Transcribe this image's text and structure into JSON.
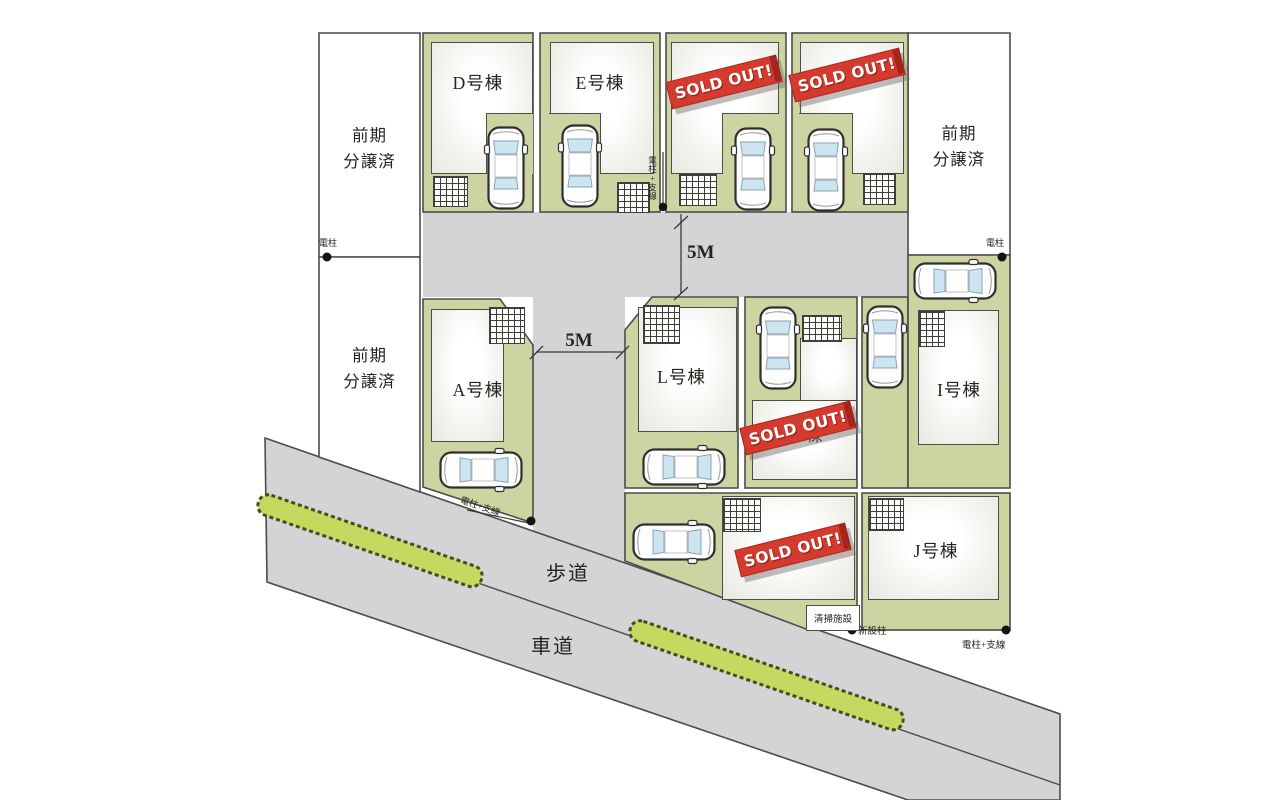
{
  "lots": {
    "d": {
      "name": "D号棟",
      "sold_out": false
    },
    "e": {
      "name": "E号棟",
      "sold_out": false
    },
    "f": {
      "sold_out": true
    },
    "g": {
      "sold_out": true
    },
    "a": {
      "name": "A号棟",
      "sold_out": false
    },
    "l": {
      "name": "L号棟",
      "sold_out": false
    },
    "center": {
      "name_partial": "棟",
      "sold_out": true
    },
    "i": {
      "name": "I号棟",
      "sold_out": false
    },
    "bottom_center": {
      "sold_out": true
    },
    "j": {
      "name": "J号棟",
      "sold_out": false
    }
  },
  "areas": {
    "presold_left_top": "前期\n分譲済",
    "presold_left_bottom": "前期\n分譲済",
    "presold_right": "前期\n分譲済"
  },
  "badges": {
    "sold_out": "SOLD OUT!"
  },
  "roads": {
    "sidewalk": "歩道",
    "roadway": "車道",
    "width_top": "5M",
    "width_center": "5M"
  },
  "markers": {
    "pole": "電柱",
    "pole_with_wire": "電柱+支線",
    "new_pole": "新設柱",
    "cleaning_facility": "清掃施設"
  },
  "colors": {
    "lot_green": "#ccd5a1",
    "road_gray": "#d4d4d6",
    "hedge_green": "#c4d95f",
    "sold_out_red": "#d53a2e"
  }
}
